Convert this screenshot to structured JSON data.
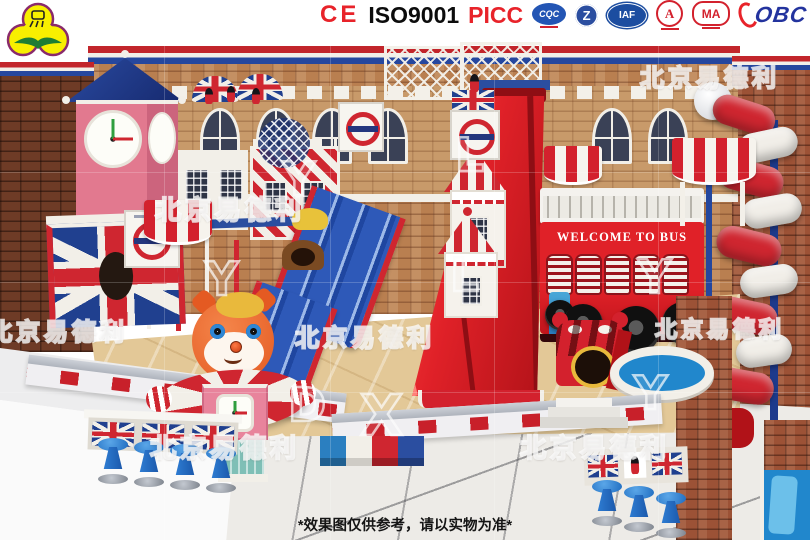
{
  "brand": {
    "watermark_text": "北京易德利",
    "watermark_letters": [
      "L",
      "Y",
      "L",
      "Y",
      "D",
      "X",
      "Y",
      "Y"
    ]
  },
  "header": {
    "ce_mark": "CE",
    "iso_label": "ISO9001",
    "picc_label": "PICC",
    "badges": {
      "cqc": "CQC",
      "z": "Z",
      "iaf": "IAF",
      "a": "A",
      "ma": "MA",
      "obc": "OBC"
    }
  },
  "scene": {
    "bus_sign": "WELCOME TO BUS"
  },
  "footer": {
    "disclaimer": "*效果图仅供参考，请以实物为准*"
  },
  "colors": {
    "theme_red": "#d3212d",
    "theme_blue": "#24479e",
    "theme_navy": "#1d3a8c",
    "cream_white": "#f2efe8",
    "brick_tan": "#b97f50",
    "brick_dark": "#6e3b26",
    "tower_pink": "#e2798f",
    "stool_blue": "#2f7fd6",
    "floor_tile": "#edebe7",
    "floor_marble": "#e3c897",
    "teal_column": "#7fbfb6",
    "mascot_orange": "#e45a22",
    "cert_red": "#e8232a",
    "cert_blue": "#23339e"
  }
}
